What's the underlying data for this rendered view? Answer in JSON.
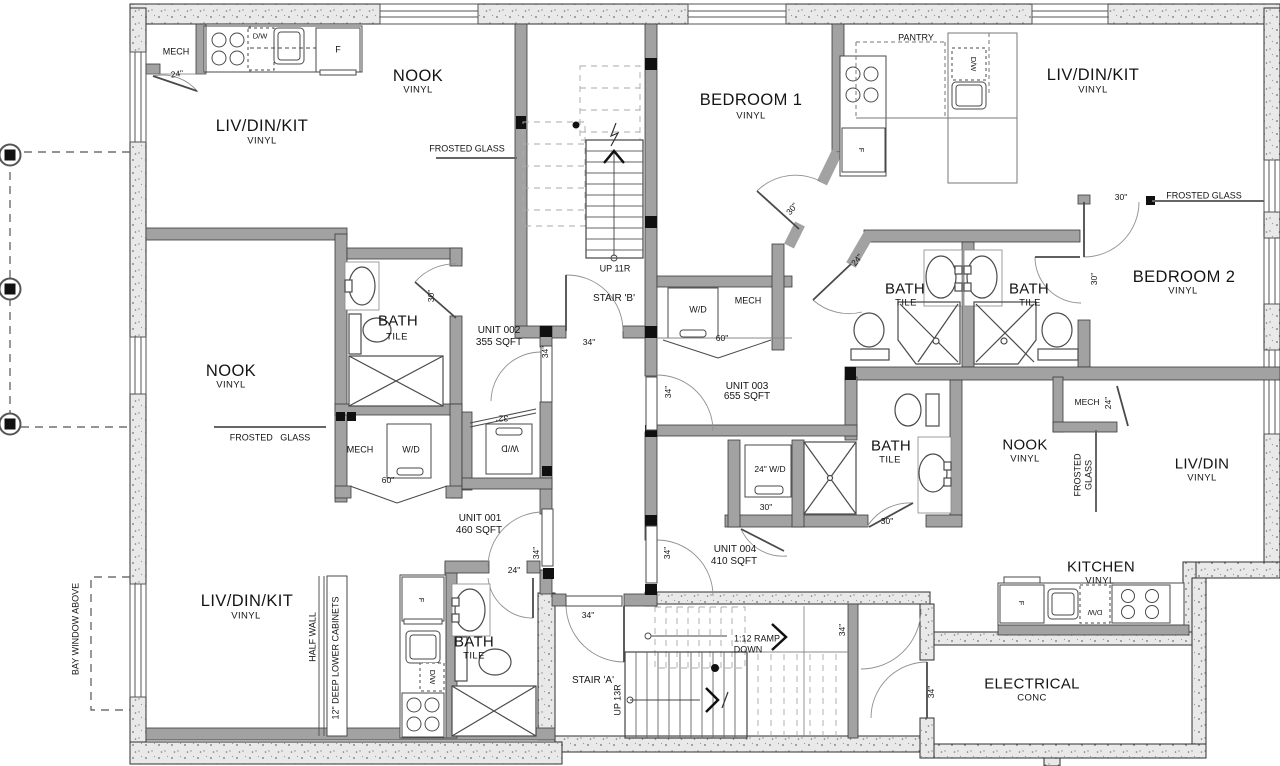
{
  "plan": {
    "rooms": [
      {
        "label": "LIV/DIN/KIT",
        "finish": "VINYL"
      },
      {
        "label": "NOOK",
        "finish": "VINYL"
      },
      {
        "label": "BEDROOM 1",
        "finish": "VINYL"
      },
      {
        "label": "LIV/DIN/KIT",
        "finish": "VINYL"
      },
      {
        "label": "BEDROOM 2",
        "finish": "VINYL"
      },
      {
        "label": "BATH",
        "finish": "TILE"
      },
      {
        "label": "BATH",
        "finish": "TILE"
      },
      {
        "label": "BATH",
        "finish": "TILE"
      },
      {
        "label": "NOOK",
        "finish": "VINYL"
      },
      {
        "label": "BATH",
        "finish": "TILE"
      },
      {
        "label": "NOOK",
        "finish": "VINYL"
      },
      {
        "label": "LIV/DIN",
        "finish": "VINYL"
      },
      {
        "label": "LIV/DIN/KIT",
        "finish": "VINYL"
      },
      {
        "label": "BATH",
        "finish": "TILE"
      },
      {
        "label": "KITCHEN",
        "finish": "VINYL"
      },
      {
        "label": "ELECTRICAL",
        "finish": "CONC"
      }
    ],
    "units": [
      {
        "name": "UNIT 001",
        "area": "460 SQFT"
      },
      {
        "name": "UNIT 002",
        "area": "355 SQFT"
      },
      {
        "name": "UNIT 003",
        "area": "655 SQFT"
      },
      {
        "name": "UNIT 004",
        "area": "410 SQFT"
      }
    ],
    "stairs": [
      {
        "name": "STAIR 'A'",
        "run": "UP 13R"
      },
      {
        "name": "STAIR 'B'",
        "run": "UP 11R"
      }
    ],
    "ramp": {
      "label": "1:12 RAMP",
      "direction": "DOWN"
    },
    "notes": {
      "frosted_glass": "FROSTED GLASS",
      "frosted_glass_spaced": "FROSTED   GLASS",
      "frosted": "FROSTED",
      "glass": "GLASS",
      "pantry": "PANTRY",
      "half_wall": "HALF WALL",
      "lower_cabinets": "12\" DEEP LOWER CABINETS",
      "bay_window": "BAY WINDOW ABOVE"
    },
    "fixtures": {
      "mech": "MECH",
      "washer_dryer": "W/D",
      "dishwasher": "D/W",
      "fridge": "F",
      "wd_24": "24\" W/D"
    },
    "dims": {
      "d24": "24\"",
      "d30": "30\"",
      "d32": "32\"",
      "d34": "34\"",
      "d60": "60\""
    }
  }
}
